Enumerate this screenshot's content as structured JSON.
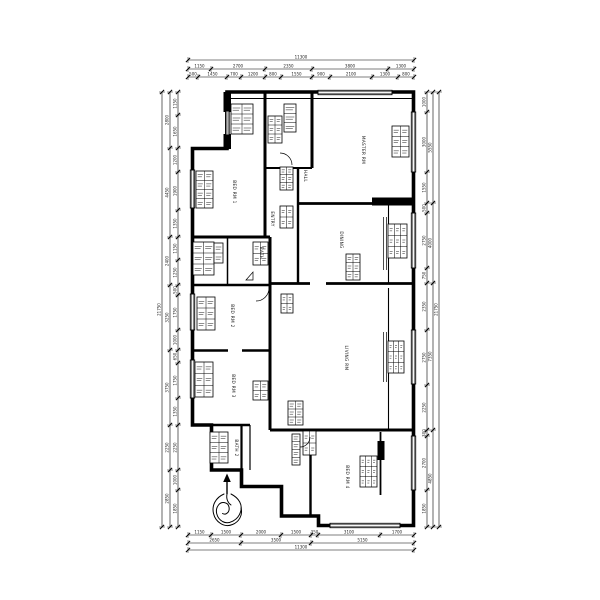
{
  "meta": {
    "drawing_type": "apartment-floor-plan"
  },
  "colors": {
    "background": "#ffffff",
    "line": "#000000",
    "text": "#1c1c1c"
  },
  "plan": {
    "room_labels": [
      {
        "label": "BED RM 1",
        "x": 233,
        "y": 192
      },
      {
        "label": "BED RM 2",
        "x": 231,
        "y": 316
      },
      {
        "label": "BED RM 3",
        "x": 232,
        "y": 386
      },
      {
        "label": "BATH",
        "x": 260,
        "y": 253
      },
      {
        "label": "MASTER RM",
        "x": 362,
        "y": 150
      },
      {
        "label": "DINING",
        "x": 340,
        "y": 240
      },
      {
        "label": "LIVING RM",
        "x": 345,
        "y": 358
      },
      {
        "label": "BED RM 4",
        "x": 346,
        "y": 477
      },
      {
        "label": "HALL",
        "x": 304,
        "y": 176
      },
      {
        "label": "ENTRY",
        "x": 271,
        "y": 219
      },
      {
        "label": "BATH 2",
        "x": 235,
        "y": 448
      }
    ],
    "dimensions": {
      "top": [
        {
          "line": 60,
          "bounds": [
            188,
            414
          ],
          "labels": [
            "11300"
          ]
        },
        {
          "line": 69,
          "bounds": [
            188,
            211,
            265,
            312,
            388,
            414
          ],
          "labels": [
            "1150",
            "2700",
            "2350",
            "3800",
            "1300"
          ]
        },
        {
          "line": 77,
          "bounds": [
            188,
            198,
            227,
            241,
            265,
            281,
            312,
            330,
            372,
            398,
            414
          ],
          "labels": [
            "500",
            "1450",
            "700",
            "1200",
            "800",
            "1550",
            "900",
            "2100",
            "1300",
            "800"
          ]
        }
      ],
      "bottom": [
        {
          "line": 535,
          "bounds": [
            188,
            211,
            241,
            281,
            311,
            318,
            380,
            414
          ],
          "labels": [
            "1150",
            "1500",
            "2000",
            "1500",
            "350",
            "3100",
            "1700"
          ]
        },
        {
          "line": 543,
          "bounds": [
            188,
            241,
            311,
            414
          ],
          "labels": [
            "2650",
            "3500",
            "5150"
          ]
        },
        {
          "line": 550,
          "bounds": [
            188,
            414
          ],
          "labels": [
            "11300"
          ]
        }
      ],
      "left": [
        {
          "line": 162,
          "bounds": [
            92,
            527
          ],
          "labels": [
            "21750"
          ]
        },
        {
          "line": 170,
          "bounds": [
            92,
            148,
            237,
            285,
            350,
            425,
            470,
            527
          ],
          "labels": [
            "2800",
            "4450",
            "2400",
            "3250",
            "3750",
            "2250",
            "2850"
          ]
        },
        {
          "line": 178,
          "bounds": [
            92,
            115,
            148,
            172,
            210,
            237,
            260,
            285,
            295,
            330,
            350,
            363,
            398,
            425,
            470,
            490,
            527
          ],
          "labels": [
            "1150",
            "1650",
            "1200",
            "1900",
            "1350",
            "1150",
            "1250",
            "500",
            "1750",
            "1000",
            "650",
            "1750",
            "1350",
            "2250",
            "1000",
            "1850"
          ]
        }
      ],
      "right": [
        {
          "line": 427,
          "bounds": [
            92,
            112,
            172,
            203,
            213,
            268,
            283,
            330,
            385,
            430,
            436,
            490,
            527
          ],
          "labels": [
            "1000",
            "3000",
            "1550",
            "500",
            "2750",
            "750",
            "2350",
            "2750",
            "2250",
            "300",
            "2700",
            "1850"
          ]
        },
        {
          "line": 433,
          "bounds": [
            92,
            203,
            283,
            430,
            527
          ],
          "labels": [
            "5550",
            "4000",
            "7350",
            "4850"
          ]
        },
        {
          "line": 439,
          "bounds": [
            92,
            527
          ],
          "labels": [
            "21750"
          ]
        }
      ]
    }
  }
}
